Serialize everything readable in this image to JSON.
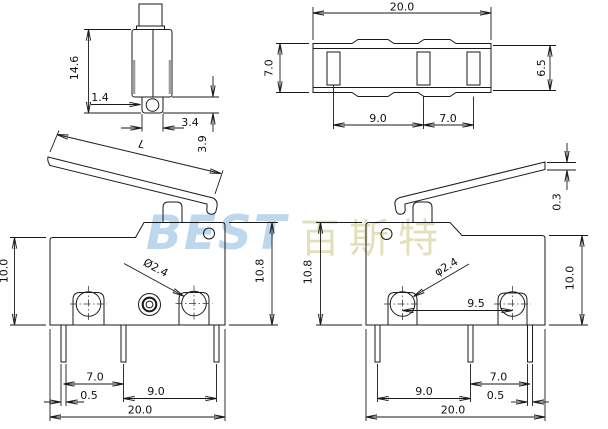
{
  "watermark": {
    "brand_latin": "BEST",
    "brand_cjk": "百斯特"
  },
  "colors": {
    "line": "#1a1a1a",
    "watermark_latin": "#b6d3ea",
    "watermark_cjk": "#d9d9ab"
  },
  "side_view": {
    "height": "14.6",
    "hole_offset": "1.4",
    "tab_width": "3.4",
    "tab_depth": "3.9"
  },
  "top_view": {
    "width": "20.0",
    "depth_left": "7.0",
    "depth_right": "6.5",
    "terminal_pitch_left": "9.0",
    "terminal_pitch_right": "7.0"
  },
  "lever": {
    "length_label": "L",
    "tip_thickness": "0.3"
  },
  "front_left": {
    "body_height": "10.0",
    "total_height": "10.8",
    "hole_diameter": "Ø2.4",
    "pin_pitch_1": "7.0",
    "pin_width": "0.5",
    "pin_pitch_2": "9.0",
    "total_width": "20.0"
  },
  "front_right": {
    "total_height": "10.8",
    "body_height": "10.0",
    "hole_diameter": "φ2.4",
    "hole_pitch": "9.5",
    "pin_pitch_1": "9.0",
    "pin_pitch_2": "7.0",
    "pin_width": "0.5",
    "total_width": "20.0"
  }
}
